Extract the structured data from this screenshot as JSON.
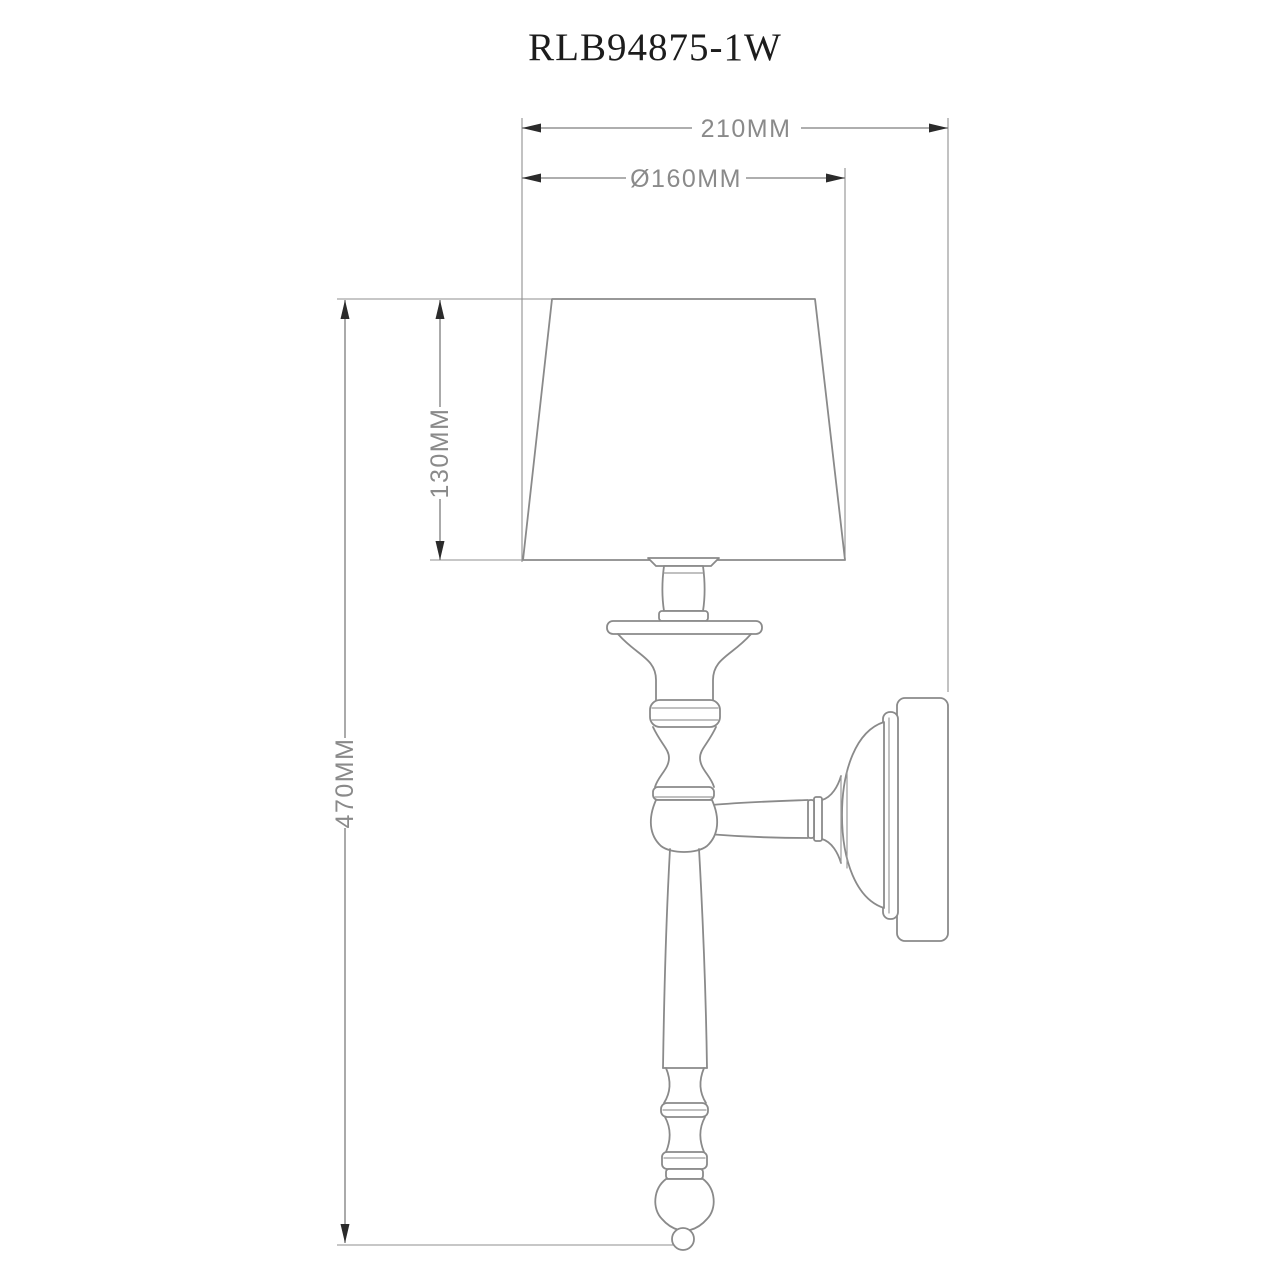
{
  "title": {
    "model_code": "RLB94875-1W"
  },
  "dimension_labels": {
    "overall_width": "210MM",
    "shade_diameter": "Ø160MM",
    "shade_height": "130MM",
    "overall_height": "470MM"
  },
  "colors": {
    "background": "#ffffff",
    "outline": "#8a8a8a",
    "dimension_line": "#7d7d7d",
    "dimension_text": "#8a8a8a",
    "arrow": "#2b2b2b",
    "title_text": "#1c1c1c"
  }
}
